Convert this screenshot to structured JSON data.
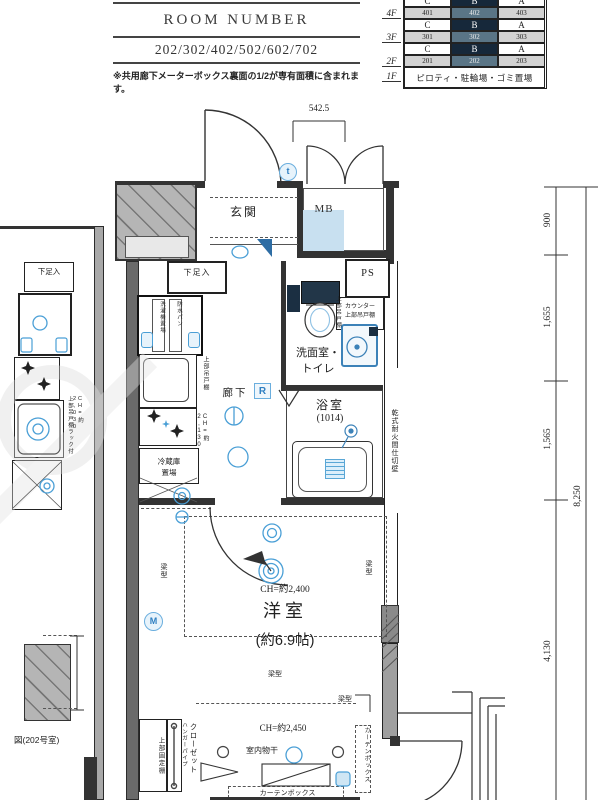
{
  "header": {
    "title": "ROOM NUMBER",
    "rooms": "202/302/402/502/602/702",
    "note": "※共用廊下メーターボックス裏面の1/2が専有面積に含まれます。"
  },
  "floor_table": {
    "col_letters": [
      "C",
      "B",
      "A"
    ],
    "rows": [
      {
        "floor": "4F",
        "nums": [
          "401",
          "402",
          "403"
        ]
      },
      {
        "floor": "3F",
        "nums": [
          "301",
          "302",
          "303"
        ]
      },
      {
        "floor": "2F",
        "nums": [
          "201",
          "202",
          "203"
        ]
      }
    ],
    "ground_floor": "1F",
    "ground_text": "ピロティ・駐輪場・ゴミ置場"
  },
  "dimensions": {
    "top": "542.5",
    "right_900": "900",
    "right_1655": "1,655",
    "right_1565": "1,565",
    "right_8250": "8,250",
    "right_4130": "4,130"
  },
  "rooms": {
    "genkan": "玄関",
    "mb": "MB",
    "ps": "PS",
    "washroom_line1": "洗面室・",
    "washroom_line2": "トイレ",
    "bath": "浴室",
    "bath_size": "(1014)",
    "corridor": "廊下",
    "main_room": "洋室",
    "main_room_size": "(約6.9帖)"
  },
  "labels": {
    "shoe_box": "下足入",
    "shoe_box_left": "下足入",
    "counter_cab_line1": "カウンター",
    "counter_cab_line2": "上部吊戸棚",
    "upper_cab": "上部吊戸棚",
    "kitchen_ch": "CH=約2,130",
    "left_upper_cab": "上部吊戸棚ラック付",
    "left_ch": "CH=約2,030",
    "washer": "洗濯機置場",
    "waterproof_pan": "防水パン",
    "fridge_line1": "冷蔵庫",
    "fridge_line2": "置場",
    "firewall": "乾式耐火間仕切壁",
    "ch_main": "CH=約2,400",
    "ch_closet": "CH=約2,450",
    "beam": "梁型",
    "closet": "クローゼット",
    "hanger_pipe": "ハンガーパイプ",
    "upper_fixed_shelf": "上部固定棚",
    "indoor_laundry": "室内物干",
    "curtain_box": "カーテンボックス",
    "room_ref": "図(202号室)"
  },
  "marks": {
    "touch_key": "t",
    "meter": "M",
    "remote": "R"
  },
  "colors": {
    "accent_blue": "#4a9fd6",
    "dark_navy": "#16283a",
    "cell_highlight": "#5a7586",
    "cell_gray": "#d2d2d2",
    "mb_fill": "#c8e0f0",
    "wall_gray": "#8f8f8f"
  }
}
